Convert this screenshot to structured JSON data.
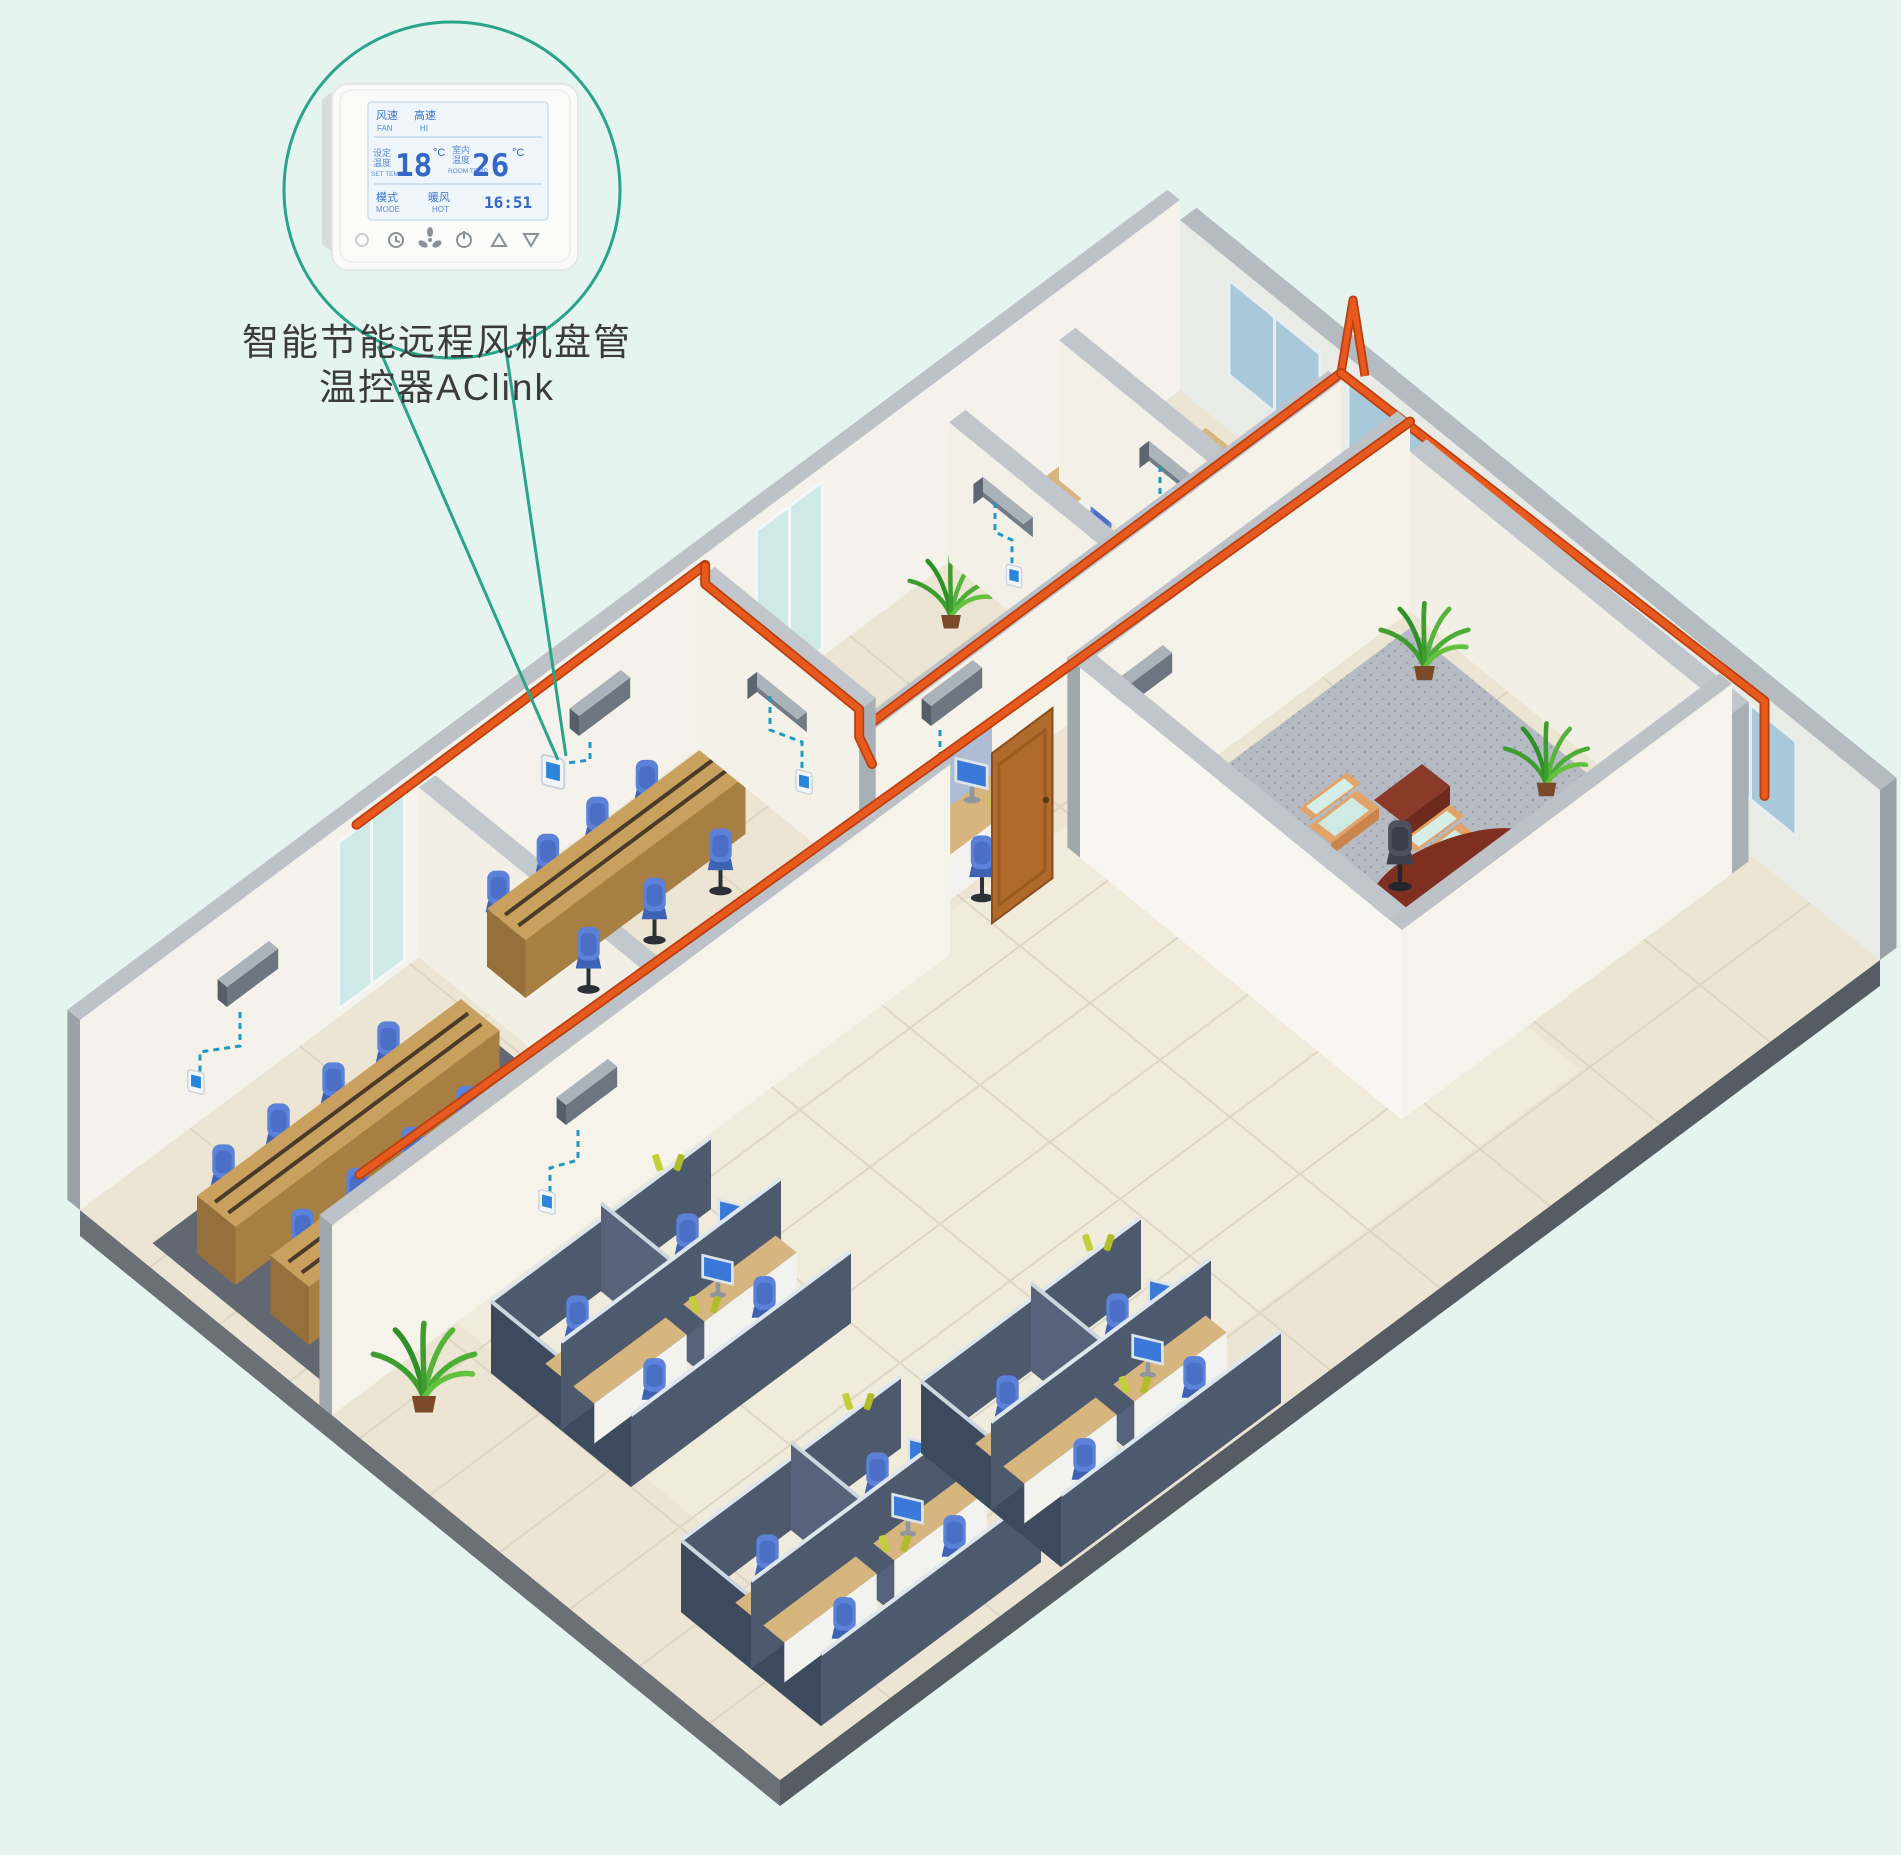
{
  "background_color": "#e6f4f0",
  "callout": {
    "circle_color": "#2aa489",
    "caption_line1": "智能节能远程风机盘管",
    "caption_line2": "温控器AClink",
    "thermostat_display": {
      "fan_label_cn": "风速",
      "fan_label_en": "FAN",
      "fan_speed_cn": "高速",
      "fan_speed_en": "HI",
      "set_label_cn_1": "设定",
      "set_label_cn_2": "温度",
      "set_label_en": "SET TEMP",
      "set_temp_value": "18",
      "temp_unit": "°C",
      "room_label_cn_1": "室内",
      "room_label_cn_2": "温度",
      "room_label_en": "ROOM TEMP",
      "room_temp_value": "26",
      "mode_label_cn": "模式",
      "mode_label_en": "MODE",
      "mode_value_cn": "暖风",
      "mode_value_en": "HOT",
      "time": "16:51"
    }
  },
  "palette": {
    "callout_teal": "#2aa489",
    "pipe_orange": "#e8591e",
    "pipe_shadow": "#b84010",
    "dashed_link_blue": "#1f9ac2",
    "thermostat_screen_blue": "#2b86d9",
    "wall_white": "#f5f2ea",
    "wall_top_gray": "#bcc2c8",
    "floor_beige": "#ece5d3",
    "window_glass_blue": "#a9c8da",
    "chair_blue": "#5b82d8",
    "desk_wood": "#d7b57e",
    "conference_wood": "#c9a05e",
    "carpet_exec_gray": "#b6bac3",
    "carpet_meeting_gray": "#616871",
    "sofa_wood": "#e2a368",
    "sofa_cushion_mint": "#d6eee8",
    "exec_desk_mahogany": "#7e2f1f",
    "door_brown": "#b06a2c",
    "fan_coil_gray": "#6d7680"
  },
  "scene": {
    "type": "isometric-office-cutaway",
    "equipment": {
      "fan_coil_units": 8,
      "wall_thermostats": 8,
      "featured_thermostats": 1
    },
    "areas": [
      "meeting-room-large",
      "meeting-room-small",
      "perimeter-offices",
      "reception-workstation",
      "executive-office",
      "open-plan-cubicles"
    ]
  }
}
